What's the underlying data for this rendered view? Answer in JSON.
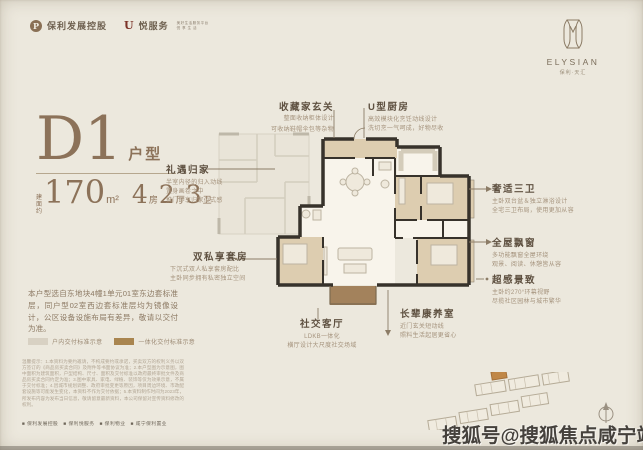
{
  "page": {
    "background": "#ece8dd",
    "accent_brown": "#8c7259",
    "wall_color": "#37322b",
    "room_tan": "#ddcdb0",
    "balcony_brown": "#a3825c"
  },
  "header": {
    "logo1": {
      "label": "保利发展控股"
    },
    "logo2": {
      "label": "悦服务",
      "sub1": "美好生活服务平台",
      "sub2": "悦 享 生 活"
    }
  },
  "brand": {
    "name": "ELYSIAN",
    "chinese": "保利·天汇"
  },
  "unit": {
    "code": "D1",
    "code_suffix": "户型",
    "area_prefix_top": "建面",
    "area_prefix_bottom": "约",
    "area": "170",
    "area_unit": "m²",
    "rooms": [
      {
        "num": "4",
        "label": "房"
      },
      {
        "num": "2",
        "label": "厅"
      },
      {
        "num": "3",
        "label": "卫"
      }
    ]
  },
  "description": "本户型选自东地块4幢1单元01室东边套标准层，同户型02室西边套标准层均为镜像设计，公区设备设施布局有差异，敬请以交付为准。",
  "legend": [
    {
      "color": "#d8d1c3",
      "label": "户内交付标准示意"
    },
    {
      "color": "#a9854f",
      "label": "一体化交付标准示意"
    }
  ],
  "callouts": {
    "entry_top": {
      "title": "收藏家玄关",
      "lines": [
        "整面收纳柜体设计",
        "可收纳鞋帽伞包等杂物"
      ]
    },
    "kitchen": {
      "title": "U型厨房",
      "lines": [
        "高效模块化烹饪动线设计",
        "洗切烹一气呵成，好物尽收"
      ]
    },
    "homecoming": {
      "title": "礼遇归家",
      "lines": [
        "半室内径的归入动线",
        "置身画卷之中",
        "推门即享归家仪式感"
      ]
    },
    "bathrooms": {
      "title": "奢适三卫",
      "lines": [
        "主卧双台盆＆独立淋浴设计",
        "全宅三卫布局，使用更加从容"
      ]
    },
    "baywindow": {
      "title": "全屋飘窗",
      "lines": [
        "多功能飘窗全屋环绕",
        "观景、阅读、休憩皆从容"
      ]
    },
    "view": {
      "title": "超感景致",
      "lines": [
        "主卧约270°环幕视野",
        "尽揽社区园林与城市繁华"
      ]
    },
    "suites": {
      "title": "双私享套房",
      "lines": [
        "下沉式双人私享套房配比",
        "主卧同步拥有私密独立空间"
      ]
    },
    "living": {
      "title": "社交客厅",
      "lines": [
        "LDKB一体化",
        "横厅设计大尺度社交场域"
      ]
    },
    "elder": {
      "title": "长辈康养室",
      "lines": [
        "近门玄关短动线",
        "照料生活起居更省心"
      ]
    }
  },
  "disclaimer": "温馨提示：1.本资料为要约邀请，不构成要约或承诺，买卖双方的权利义务以双方签订的《商品房买卖合同》及附件等书面协议为准；2.本户型图为示意图，图中面积为建筑面积，户型结构、尺寸、面积及交付标准以政府最终审批文件及商品房买卖合同约定为准；3.图中家具、家电、绿植、装饰等仅为效果示意，不属于交付标准；4.因城市规划调整、政府审批变更等原因，项目周边环境、市政配套设施等可能发生变化，本资料不作为交付依据；5.本资料制作时间为2023年，所发布内容为发布当日信息，敬请留意最新资料，本公司保留对宣传资料修改的权利。",
  "footnote": "■ 保利发展控股　■ 保利悦服务　■ 保利物业　■ 咸宁保利置业",
  "watermark": "搜狐号@搜狐焦点咸宁站"
}
